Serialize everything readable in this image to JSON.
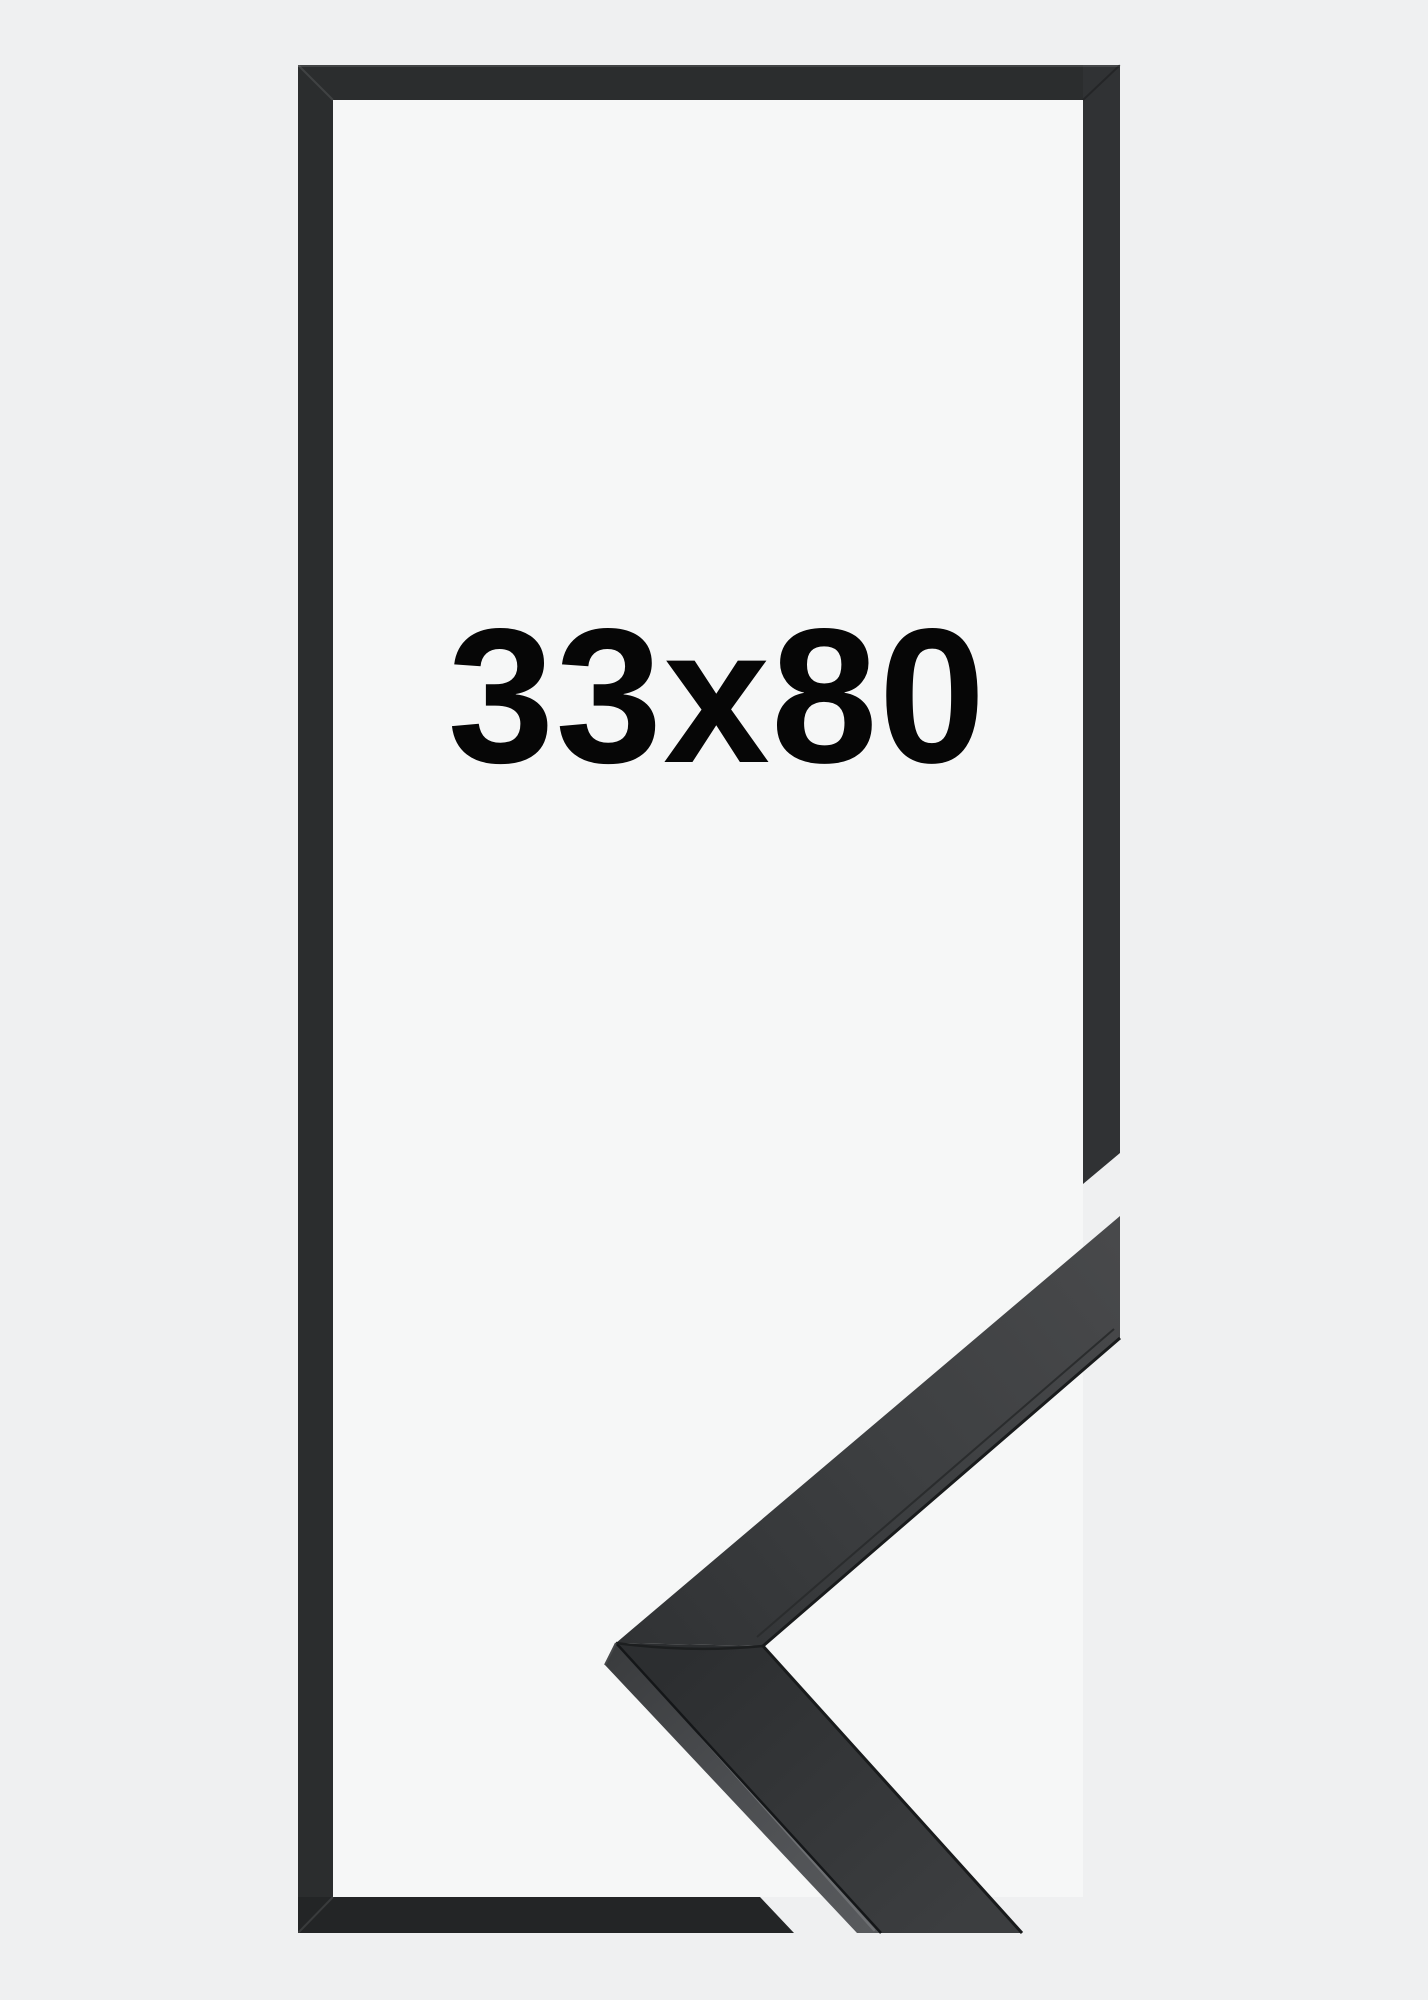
{
  "product": {
    "size_label": "33x80"
  },
  "colors": {
    "background": "#eff0f1",
    "inner_background": "#f6f7f7",
    "frame_bar": "#2b2d2e",
    "frame_bar_right": "#303234",
    "frame_bar_bottom": "#232526",
    "size_label_text": "#060606",
    "molding_face_dark": "#2c2e30",
    "molding_face_light": "#48494b",
    "molding_side_light": "#57595c",
    "edge_shadow": "#191b1c",
    "ridge_highlight": "#6d6f72"
  }
}
